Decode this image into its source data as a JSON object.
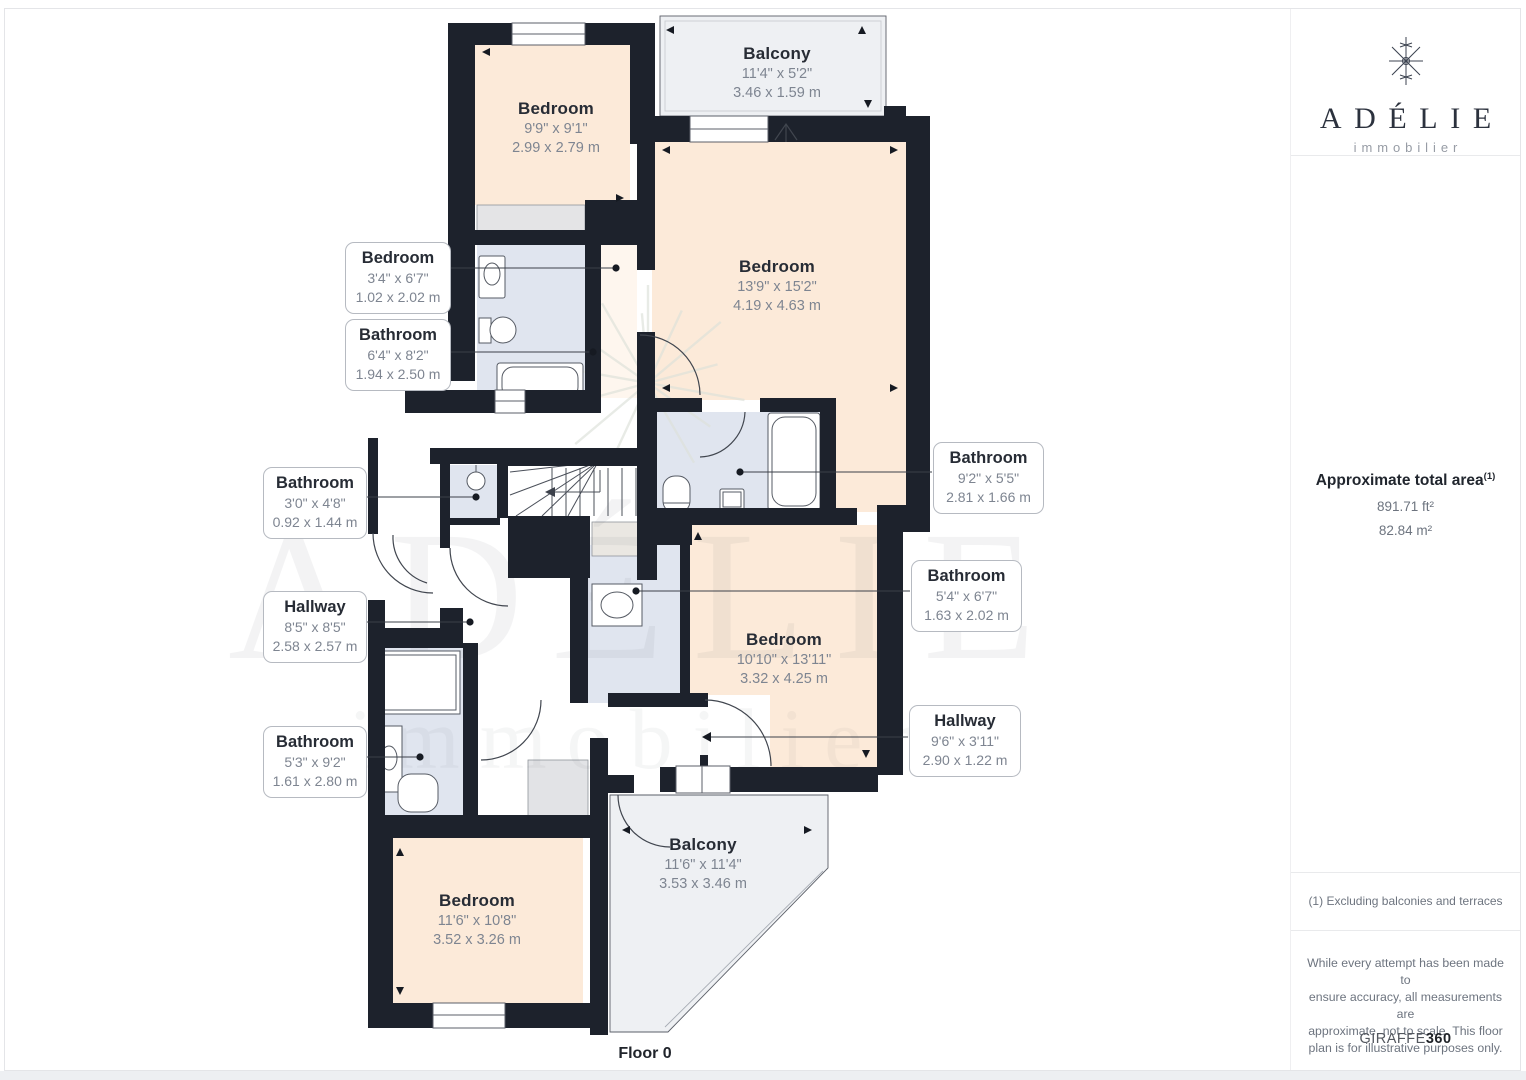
{
  "plan": {
    "floor_label": "Floor 0",
    "watermark": {
      "line1": "ADÉLIE",
      "line2": "immobilier"
    },
    "rooms": {
      "balcony_top": {
        "name": "Balcony",
        "imperial": "11'4\" x 5'2\"",
        "metric": "3.46 x 1.59 m"
      },
      "bedroom_top_left": {
        "name": "Bedroom",
        "imperial": "9'9\" x 9'1\"",
        "metric": "2.99 x 2.79 m"
      },
      "bedroom_large": {
        "name": "Bedroom",
        "imperial": "13'9\" x 15'2\"",
        "metric": "4.19 x 4.63 m"
      },
      "bedroom_right": {
        "name": "Bedroom",
        "imperial": "10'10\" x 13'11\"",
        "metric": "3.32 x 4.25 m"
      },
      "bedroom_bottom": {
        "name": "Bedroom",
        "imperial": "11'6\" x 10'8\"",
        "metric": "3.52 x 3.26 m"
      },
      "balcony_bottom": {
        "name": "Balcony",
        "imperial": "11'6\" x 11'4\"",
        "metric": "3.53 x 3.46 m"
      }
    },
    "callouts": {
      "bedroom_small": {
        "name": "Bedroom",
        "imperial": "3'4\" x 6'7\"",
        "metric": "1.02 x 2.02 m"
      },
      "bathroom_64": {
        "name": "Bathroom",
        "imperial": "6'4\" x 8'2\"",
        "metric": "1.94 x 2.50 m"
      },
      "bathroom_30": {
        "name": "Bathroom",
        "imperial": "3'0\" x 4'8\"",
        "metric": "0.92 x 1.44 m"
      },
      "hallway_85": {
        "name": "Hallway",
        "imperial": "8'5\" x 8'5\"",
        "metric": "2.58 x 2.57 m"
      },
      "bathroom_53": {
        "name": "Bathroom",
        "imperial": "5'3\" x 9'2\"",
        "metric": "1.61 x 2.80 m"
      },
      "bathroom_92": {
        "name": "Bathroom",
        "imperial": "9'2\" x 5'5\"",
        "metric": "2.81 x 1.66 m"
      },
      "bathroom_54": {
        "name": "Bathroom",
        "imperial": "5'4\" x 6'7\"",
        "metric": "1.63 x 2.02 m"
      },
      "hallway_96": {
        "name": "Hallway",
        "imperial": "9'6\" x 3'11\"",
        "metric": "2.90 x 1.22 m"
      }
    }
  },
  "sidebar": {
    "brand": {
      "name": "ADÉLIE",
      "tagline": "immobilier"
    },
    "area": {
      "title": "Approximate total area",
      "superscript": "(1)",
      "imperial": "891.71 ft²",
      "metric": "82.84 m²"
    },
    "footnote": "(1) Excluding balconies and terraces",
    "disclaimer": "While every attempt has been made to\nensure accuracy, all measurements are\napproximate, not to scale. This floor\nplan is for illustrative purposes only.",
    "credit": {
      "name": "GIRAFFE",
      "suffix": "360"
    }
  },
  "colors": {
    "wall": "#1d222c",
    "bedroom_fill": "#fcead9",
    "bathroom_fill": "#e0e5ef",
    "balcony_fill": "#eef0f3"
  }
}
